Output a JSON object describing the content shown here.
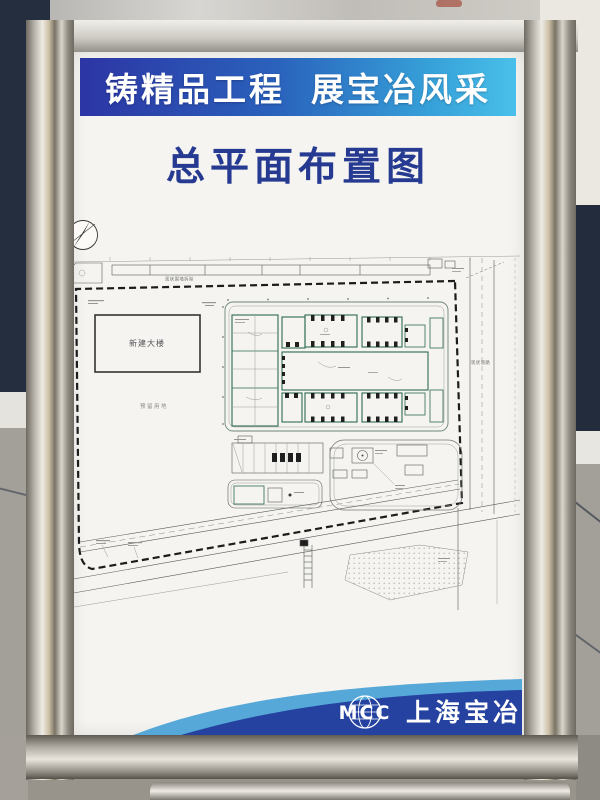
{
  "banner": {
    "slogan_left": "铸精品工程",
    "slogan_right": "展宝冶风采"
  },
  "title": {
    "text": "总平面布置图"
  },
  "plan": {
    "labels": {
      "new_building": "新建大楼",
      "reserved_land": "预留用地",
      "existing_wall": "现状围墙拆除",
      "existing_road": "现状道路"
    }
  },
  "footer": {
    "logo_text": "MCC",
    "company_name": "上海宝冶"
  },
  "colors": {
    "banner_blue_start": "#2c35a4",
    "banner_blue_end": "#49c0ea",
    "title_blue": "#253a90",
    "plan_green": "#2e6b52",
    "footer_dark_blue": "#2542a0",
    "footer_light_blue": "#55a8d8"
  }
}
